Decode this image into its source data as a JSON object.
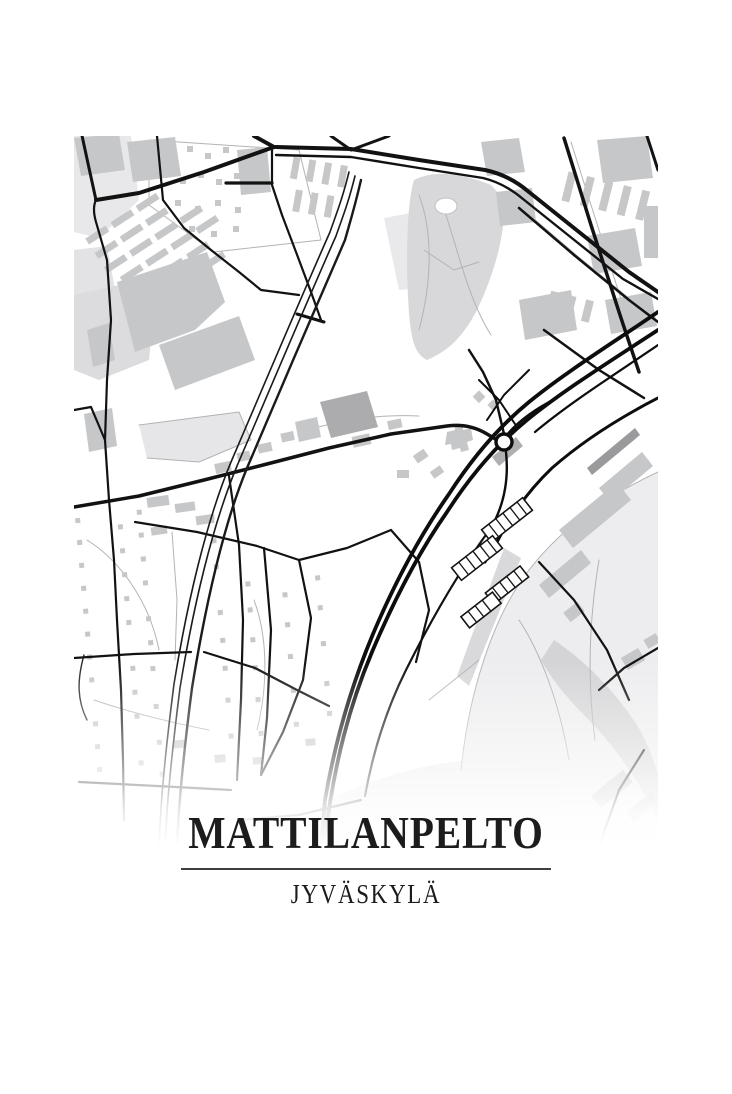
{
  "poster": {
    "title": "MATTILANPELTO",
    "subtitle": "JYVÄSKYLÄ",
    "style": {
      "background_color": "#ffffff",
      "text_color": "#1c1c1c",
      "divider_color": "#3f3f3f",
      "road_color": "#121212",
      "minor_path_color": "#b3b3b5",
      "building_color": "#c6c7c9",
      "dark_building_color": "#a8a8aa",
      "park_color": "#d8d8da",
      "open_area_color": "#ededef",
      "shore_band_color": "#d4d4d6"
    },
    "map": {
      "type": "monochrome street map",
      "features": [
        "motorway-bundle",
        "roundabout",
        "railway-line",
        "main-road",
        "apartment-block-rows",
        "industrial-buildings",
        "residential-house-dots",
        "terraced-house-ladders",
        "park-with-pond",
        "open-field",
        "shoreline-band"
      ]
    }
  }
}
